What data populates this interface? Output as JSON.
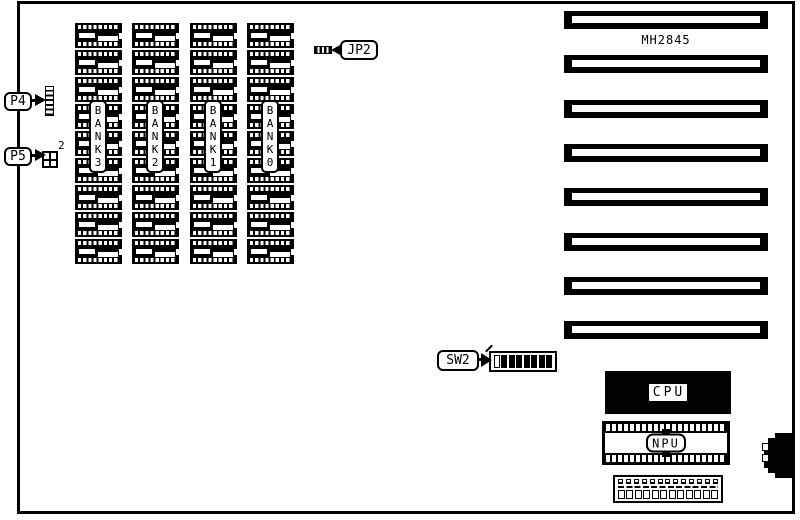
{
  "board": {
    "ink": "#000000",
    "background": "#ffffff"
  },
  "memory": {
    "chips_per_bank": 9,
    "banks": [
      {
        "name": "BANK 3",
        "letters": [
          "B",
          "A",
          "N",
          "K",
          "3"
        ]
      },
      {
        "name": "BANK 2",
        "letters": [
          "B",
          "A",
          "N",
          "K",
          "2"
        ]
      },
      {
        "name": "BANK 1",
        "letters": [
          "B",
          "A",
          "N",
          "K",
          "1"
        ]
      },
      {
        "name": "BANK 0",
        "letters": [
          "B",
          "A",
          "N",
          "K",
          "0"
        ]
      }
    ]
  },
  "connectors": {
    "p4": {
      "label": "P4",
      "pins": 6
    },
    "p5": {
      "label": "P5",
      "pin_number": "2"
    },
    "jp2": {
      "label": "JP2"
    },
    "sw2": {
      "label": "SW2",
      "switches": [
        "open",
        "closed",
        "closed",
        "closed",
        "closed",
        "closed",
        "closed",
        "closed"
      ]
    },
    "keyboard": {
      "pins": 2
    }
  },
  "chips": {
    "board_chip": "MH2845",
    "cpu": "CPU",
    "npu": "NPU"
  },
  "expansion_slots": {
    "count": 8
  },
  "bottom_connector": {
    "top_cells": 13,
    "bottom_cells": 12
  }
}
